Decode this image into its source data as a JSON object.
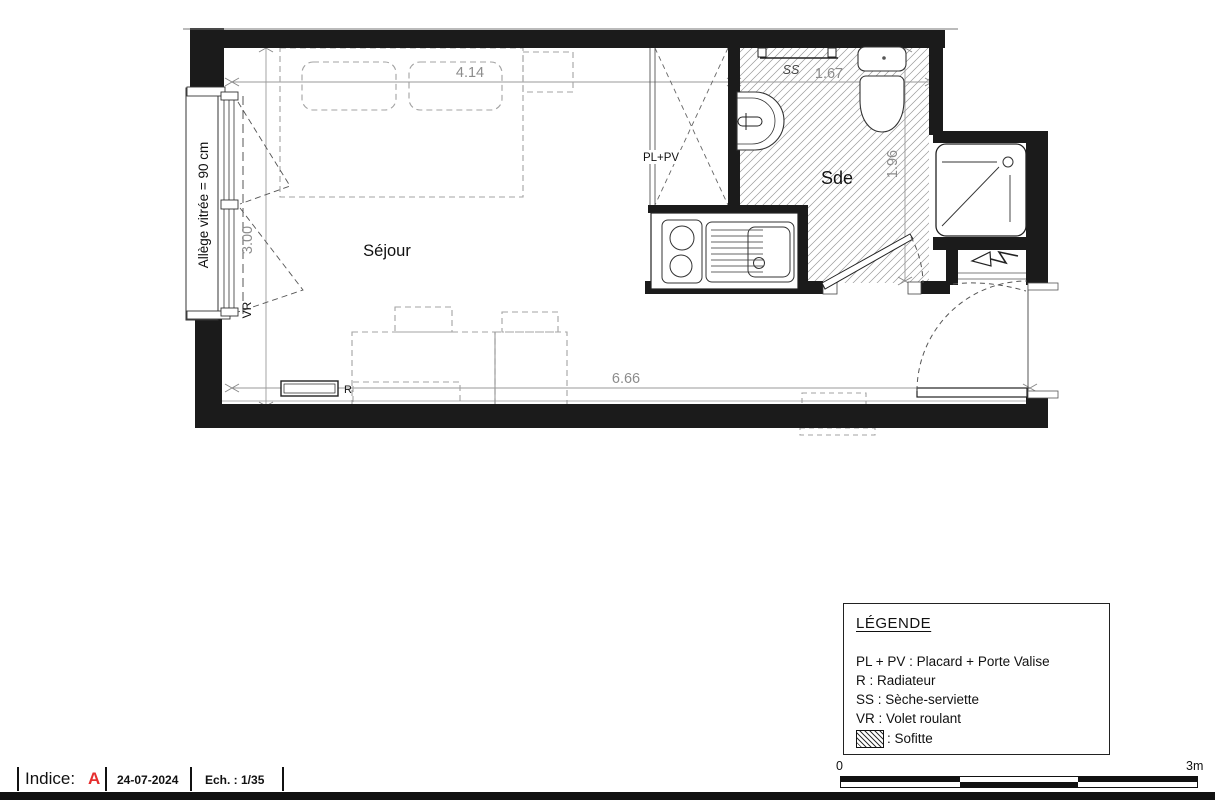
{
  "plan": {
    "rooms": {
      "sejour": "Séjour",
      "sde": "Sde"
    },
    "labels": {
      "pl_pv": "PL+PV",
      "ss": "SS",
      "vr": "VR",
      "r": "R",
      "allege": "Allège vitrée = 90 cm"
    },
    "dimensions": {
      "sejour_width": "4.14",
      "sde_width": "1.67",
      "sejour_height": "3.00",
      "sde_height": "1.96",
      "total_width": "6.66"
    }
  },
  "legend": {
    "title": "LÉGENDE",
    "items": [
      "PL + PV : Placard + Porte Valise",
      "R : Radiateur",
      "SS : Sèche-serviette",
      "VR : Volet roulant"
    ],
    "sofitte_label": ": Sofitte"
  },
  "scale_bar": {
    "start": "0",
    "end": "3m"
  },
  "footer": {
    "indice_label": "Indice:",
    "indice_value": "A",
    "date": "24-07-2024",
    "scale": "Ech. : 1/35"
  },
  "colors": {
    "wall": "#1b1b1b",
    "dimension": "#8c8c8c",
    "indice_red": "#e62e2e"
  }
}
